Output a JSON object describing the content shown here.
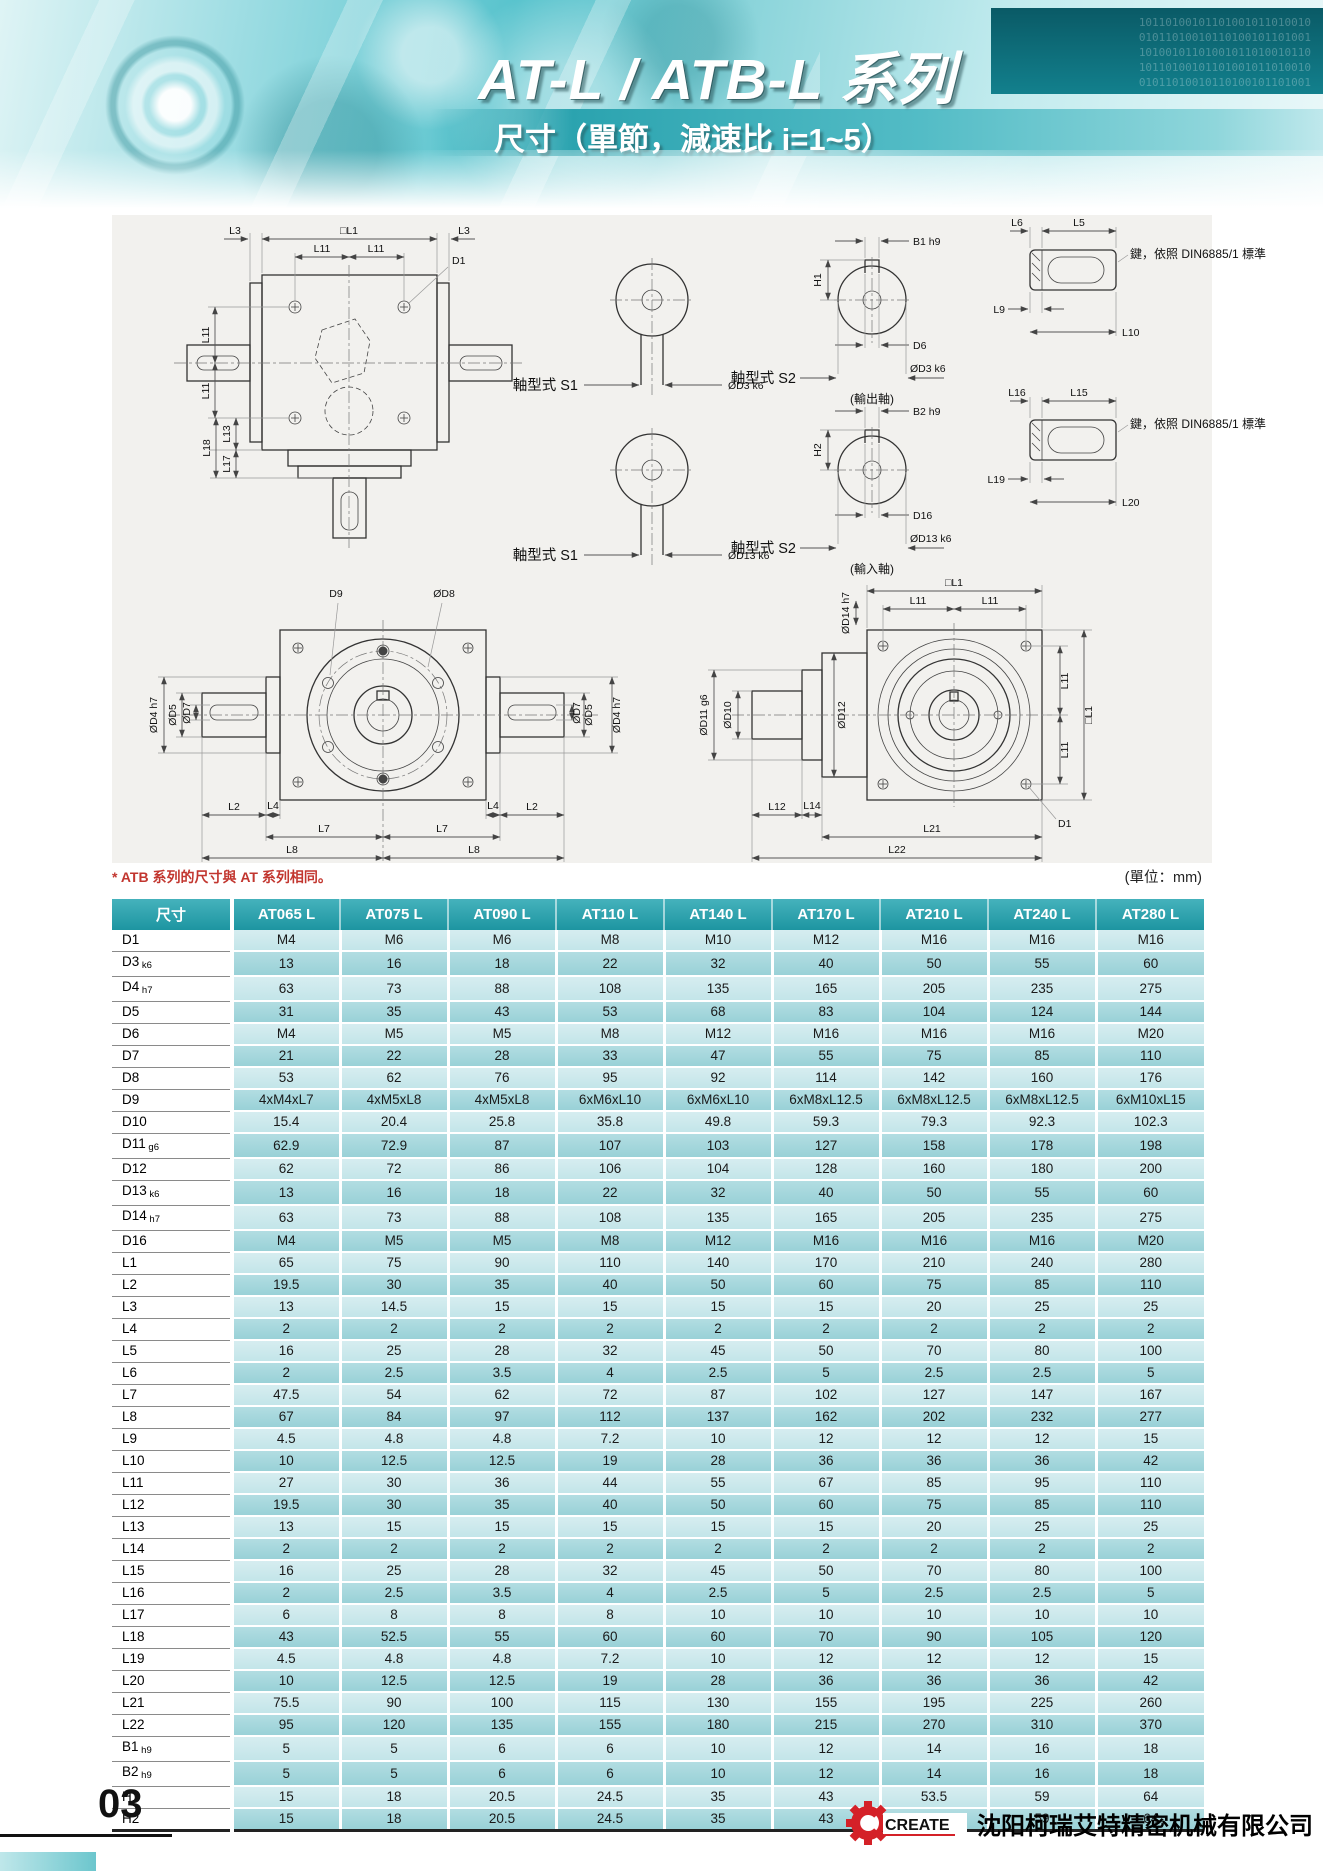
{
  "header": {
    "title": "AT-L / ATB-L 系列",
    "subtitle": "尺寸（單節，減速比 i=1~5）",
    "digits1": "10110100101101001011010010",
    "digits2": "01011010010110100101101001",
    "digits3": "10100101101001011010010110"
  },
  "note": {
    "atb": "* ATB 系列的尺寸與 AT 系列相同。",
    "unit": "(單位：mm)"
  },
  "dw": {
    "sqL1": "□L1",
    "l2": "L2",
    "l3": "L3",
    "l4": "L4",
    "l5": "L5",
    "l6": "L6",
    "l7": "L7",
    "l8": "L8",
    "l9": "L9",
    "l10": "L10",
    "l11": "L11",
    "l12": "L12",
    "l13": "L13",
    "l14": "L14",
    "l15": "L15",
    "l16": "L16",
    "l17": "L17",
    "l18": "L18",
    "l19": "L19",
    "l20": "L20",
    "l21": "L21",
    "l22": "L22",
    "d1": "D1",
    "d6": "D6",
    "d9": "D9",
    "d16": "D16",
    "b1": "B1 h9",
    "b2": "B2 h9",
    "h1": "H1",
    "h2": "H2",
    "dd3": "ØD3 k6",
    "dd13": "ØD13 k6",
    "dd4": "ØD4 h7",
    "dd5": "ØD5",
    "dd7": "ØD7",
    "dd8": "ØD8",
    "dd10": "ØD10",
    "dd11": "ØD11 g6",
    "dd12": "ØD12",
    "dd14": "ØD14 h7",
    "s1": "軸型式 S1",
    "s2": "軸型式 S2",
    "outShaft": "(輸出軸)",
    "inShaft": "(輸入軸)",
    "keyNote": "鍵，依照 DIN6885/1 標準"
  },
  "table": {
    "columns": [
      "尺寸",
      "AT065 L",
      "AT075 L",
      "AT090 L",
      "AT110 L",
      "AT140 L",
      "AT170 L",
      "AT210 L",
      "AT240 L",
      "AT280 L"
    ],
    "rows": [
      {
        "label": "D1",
        "sub": "",
        "values": [
          "M4",
          "M6",
          "M6",
          "M8",
          "M10",
          "M12",
          "M16",
          "M16",
          "M16"
        ]
      },
      {
        "label": "D3",
        "sub": "k6",
        "values": [
          "13",
          "16",
          "18",
          "22",
          "32",
          "40",
          "50",
          "55",
          "60"
        ]
      },
      {
        "label": "D4",
        "sub": "h7",
        "values": [
          "63",
          "73",
          "88",
          "108",
          "135",
          "165",
          "205",
          "235",
          "275"
        ]
      },
      {
        "label": "D5",
        "sub": "",
        "values": [
          "31",
          "35",
          "43",
          "53",
          "68",
          "83",
          "104",
          "124",
          "144"
        ]
      },
      {
        "label": "D6",
        "sub": "",
        "values": [
          "M4",
          "M5",
          "M5",
          "M8",
          "M12",
          "M16",
          "M16",
          "M16",
          "M20"
        ]
      },
      {
        "label": "D7",
        "sub": "",
        "values": [
          "21",
          "22",
          "28",
          "33",
          "47",
          "55",
          "75",
          "85",
          "110"
        ]
      },
      {
        "label": "D8",
        "sub": "",
        "values": [
          "53",
          "62",
          "76",
          "95",
          "92",
          "114",
          "142",
          "160",
          "176"
        ]
      },
      {
        "label": "D9",
        "sub": "",
        "values": [
          "4xM4xL7",
          "4xM5xL8",
          "4xM5xL8",
          "6xM6xL10",
          "6xM6xL10",
          "6xM8xL12.5",
          "6xM8xL12.5",
          "6xM8xL12.5",
          "6xM10xL15"
        ]
      },
      {
        "label": "D10",
        "sub": "",
        "values": [
          "15.4",
          "20.4",
          "25.8",
          "35.8",
          "49.8",
          "59.3",
          "79.3",
          "92.3",
          "102.3"
        ]
      },
      {
        "label": "D11",
        "sub": "g6",
        "values": [
          "62.9",
          "72.9",
          "87",
          "107",
          "103",
          "127",
          "158",
          "178",
          "198"
        ]
      },
      {
        "label": "D12",
        "sub": "",
        "values": [
          "62",
          "72",
          "86",
          "106",
          "104",
          "128",
          "160",
          "180",
          "200"
        ]
      },
      {
        "label": "D13",
        "sub": "k6",
        "values": [
          "13",
          "16",
          "18",
          "22",
          "32",
          "40",
          "50",
          "55",
          "60"
        ]
      },
      {
        "label": "D14",
        "sub": "h7",
        "values": [
          "63",
          "73",
          "88",
          "108",
          "135",
          "165",
          "205",
          "235",
          "275"
        ]
      },
      {
        "label": "D16",
        "sub": "",
        "values": [
          "M4",
          "M5",
          "M5",
          "M8",
          "M12",
          "M16",
          "M16",
          "M16",
          "M20"
        ]
      },
      {
        "label": "L1",
        "sub": "",
        "values": [
          "65",
          "75",
          "90",
          "110",
          "140",
          "170",
          "210",
          "240",
          "280"
        ]
      },
      {
        "label": "L2",
        "sub": "",
        "values": [
          "19.5",
          "30",
          "35",
          "40",
          "50",
          "60",
          "75",
          "85",
          "110"
        ]
      },
      {
        "label": "L3",
        "sub": "",
        "values": [
          "13",
          "14.5",
          "15",
          "15",
          "15",
          "15",
          "20",
          "25",
          "25"
        ]
      },
      {
        "label": "L4",
        "sub": "",
        "values": [
          "2",
          "2",
          "2",
          "2",
          "2",
          "2",
          "2",
          "2",
          "2"
        ]
      },
      {
        "label": "L5",
        "sub": "",
        "values": [
          "16",
          "25",
          "28",
          "32",
          "45",
          "50",
          "70",
          "80",
          "100"
        ]
      },
      {
        "label": "L6",
        "sub": "",
        "values": [
          "2",
          "2.5",
          "3.5",
          "4",
          "2.5",
          "5",
          "2.5",
          "2.5",
          "5"
        ]
      },
      {
        "label": "L7",
        "sub": "",
        "values": [
          "47.5",
          "54",
          "62",
          "72",
          "87",
          "102",
          "127",
          "147",
          "167"
        ]
      },
      {
        "label": "L8",
        "sub": "",
        "values": [
          "67",
          "84",
          "97",
          "112",
          "137",
          "162",
          "202",
          "232",
          "277"
        ]
      },
      {
        "label": "L9",
        "sub": "",
        "values": [
          "4.5",
          "4.8",
          "4.8",
          "7.2",
          "10",
          "12",
          "12",
          "12",
          "15"
        ]
      },
      {
        "label": "L10",
        "sub": "",
        "values": [
          "10",
          "12.5",
          "12.5",
          "19",
          "28",
          "36",
          "36",
          "36",
          "42"
        ]
      },
      {
        "label": "L11",
        "sub": "",
        "values": [
          "27",
          "30",
          "36",
          "44",
          "55",
          "67",
          "85",
          "95",
          "110"
        ]
      },
      {
        "label": "L12",
        "sub": "",
        "values": [
          "19.5",
          "30",
          "35",
          "40",
          "50",
          "60",
          "75",
          "85",
          "110"
        ]
      },
      {
        "label": "L13",
        "sub": "",
        "values": [
          "13",
          "15",
          "15",
          "15",
          "15",
          "15",
          "20",
          "25",
          "25"
        ]
      },
      {
        "label": "L14",
        "sub": "",
        "values": [
          "2",
          "2",
          "2",
          "2",
          "2",
          "2",
          "2",
          "2",
          "2"
        ]
      },
      {
        "label": "L15",
        "sub": "",
        "values": [
          "16",
          "25",
          "28",
          "32",
          "45",
          "50",
          "70",
          "80",
          "100"
        ]
      },
      {
        "label": "L16",
        "sub": "",
        "values": [
          "2",
          "2.5",
          "3.5",
          "4",
          "2.5",
          "5",
          "2.5",
          "2.5",
          "5"
        ]
      },
      {
        "label": "L17",
        "sub": "",
        "values": [
          "6",
          "8",
          "8",
          "8",
          "10",
          "10",
          "10",
          "10",
          "10"
        ]
      },
      {
        "label": "L18",
        "sub": "",
        "values": [
          "43",
          "52.5",
          "55",
          "60",
          "60",
          "70",
          "90",
          "105",
          "120"
        ]
      },
      {
        "label": "L19",
        "sub": "",
        "values": [
          "4.5",
          "4.8",
          "4.8",
          "7.2",
          "10",
          "12",
          "12",
          "12",
          "15"
        ]
      },
      {
        "label": "L20",
        "sub": "",
        "values": [
          "10",
          "12.5",
          "12.5",
          "19",
          "28",
          "36",
          "36",
          "36",
          "42"
        ]
      },
      {
        "label": "L21",
        "sub": "",
        "values": [
          "75.5",
          "90",
          "100",
          "115",
          "130",
          "155",
          "195",
          "225",
          "260"
        ]
      },
      {
        "label": "L22",
        "sub": "",
        "values": [
          "95",
          "120",
          "135",
          "155",
          "180",
          "215",
          "270",
          "310",
          "370"
        ]
      },
      {
        "label": "B1",
        "sub": "h9",
        "values": [
          "5",
          "5",
          "6",
          "6",
          "10",
          "12",
          "14",
          "16",
          "18"
        ]
      },
      {
        "label": "B2",
        "sub": "h9",
        "values": [
          "5",
          "5",
          "6",
          "6",
          "10",
          "12",
          "14",
          "16",
          "18"
        ]
      },
      {
        "label": "H1",
        "sub": "",
        "values": [
          "15",
          "18",
          "20.5",
          "24.5",
          "35",
          "43",
          "53.5",
          "59",
          "64"
        ]
      },
      {
        "label": "H2",
        "sub": "",
        "values": [
          "15",
          "18",
          "20.5",
          "24.5",
          "35",
          "43",
          "53.5",
          "59",
          "64"
        ]
      }
    ]
  },
  "footer": {
    "page": "03",
    "brand": "CREATE",
    "company": "沈阳柯瑞艾特精密机械有限公司"
  }
}
